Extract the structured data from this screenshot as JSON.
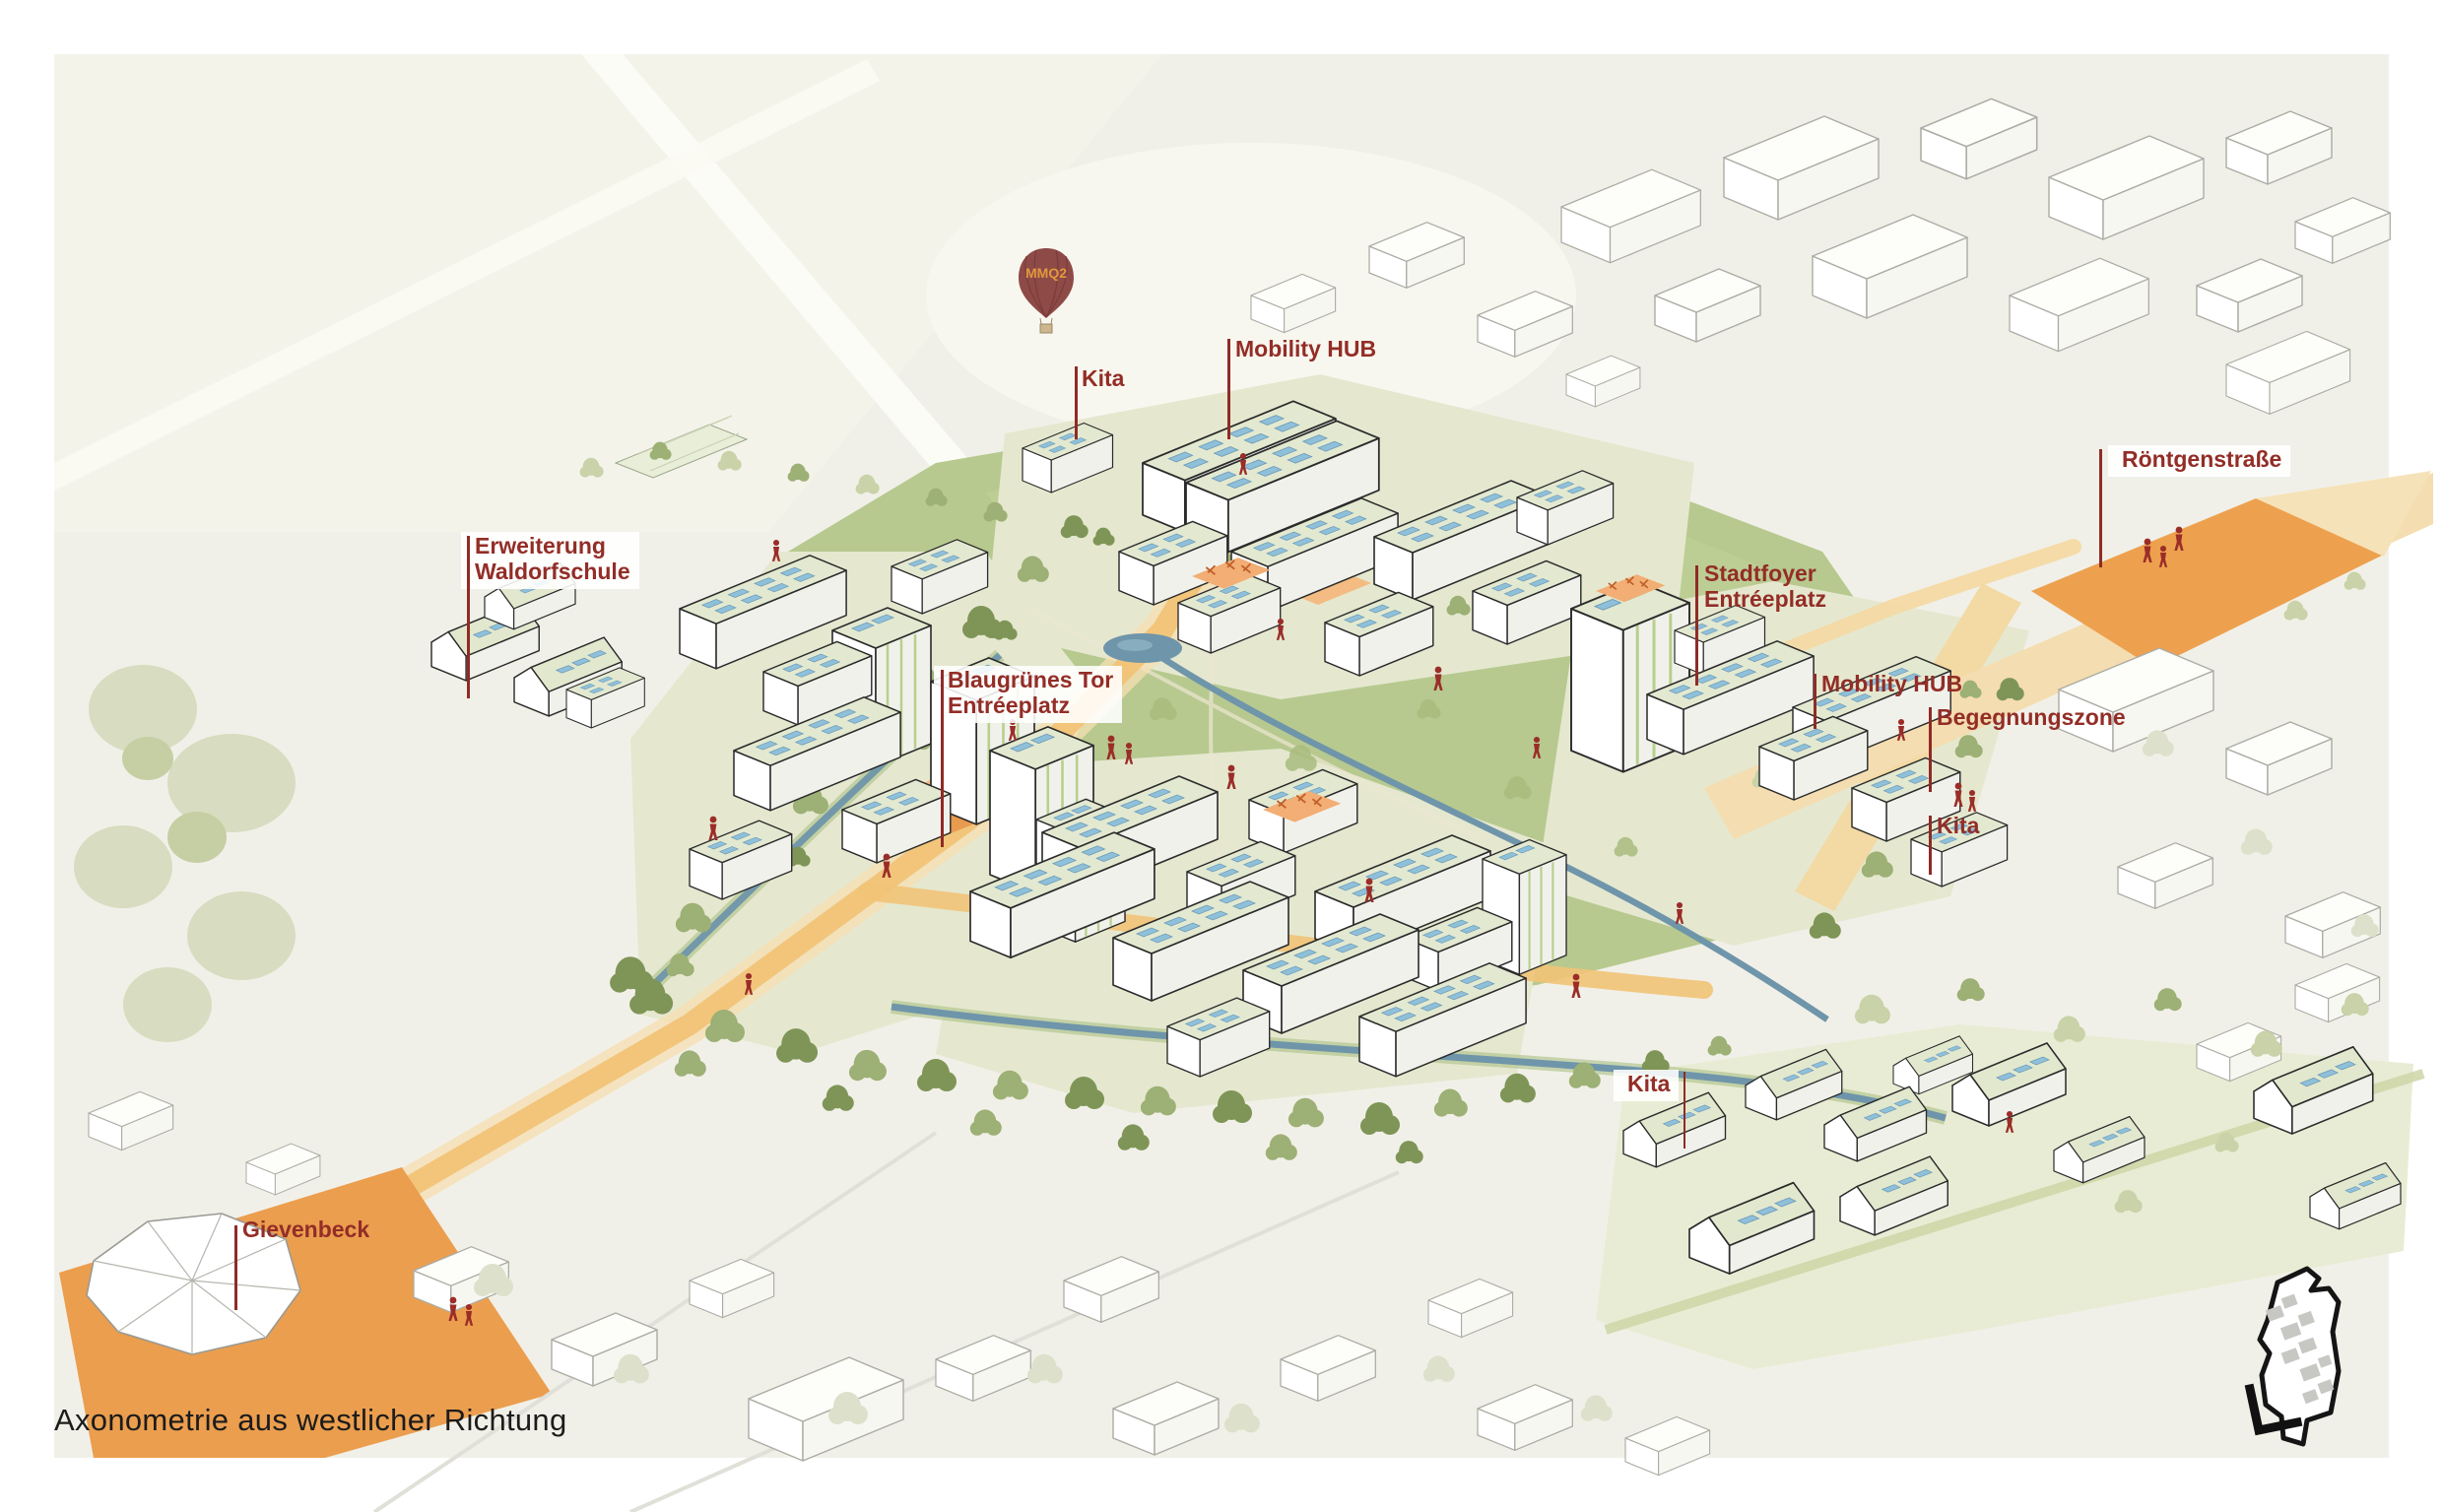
{
  "page": {
    "caption": "Axonometrie aus westlicher Richtung"
  },
  "balloon": {
    "label": "MMQ2"
  },
  "annotations": {
    "kita_north": {
      "label": "Kita"
    },
    "mobility_hub_north": {
      "label": "Mobility HUB"
    },
    "roentgenstrasse": {
      "label": "Röntgenstraße"
    },
    "erweiterung_waldorfschule": {
      "line1": "Erweiterung",
      "line2": "Waldorfschule"
    },
    "stadtfoyer_entreeplatz": {
      "line1": "Stadtfoyer",
      "line2": "Entréeplatz"
    },
    "blaugruenes_tor_entreeplatz": {
      "line1": "Blaugrünes Tor",
      "line2": "Entréeplatz"
    },
    "mobility_hub_east": {
      "label": "Mobility HUB"
    },
    "begegnungszone": {
      "label": "Begegnungszone"
    },
    "kita_east": {
      "label": "Kita"
    },
    "kita_south": {
      "label": "Kita"
    },
    "gievenbeck": {
      "label": "Gievenbeck"
    }
  },
  "colors": {
    "annotation_red": "#8f2b26",
    "figure_red": "#9b2d28",
    "path_orange": "#eda14f",
    "path_light_orange": "#f1c377",
    "park_green": "#b7c98f",
    "tree_olive": "#7f9557",
    "water_blue": "#6f95aa",
    "solar_panel_blue": "#8fc0da",
    "canvas_background": "#f1f0e8"
  }
}
